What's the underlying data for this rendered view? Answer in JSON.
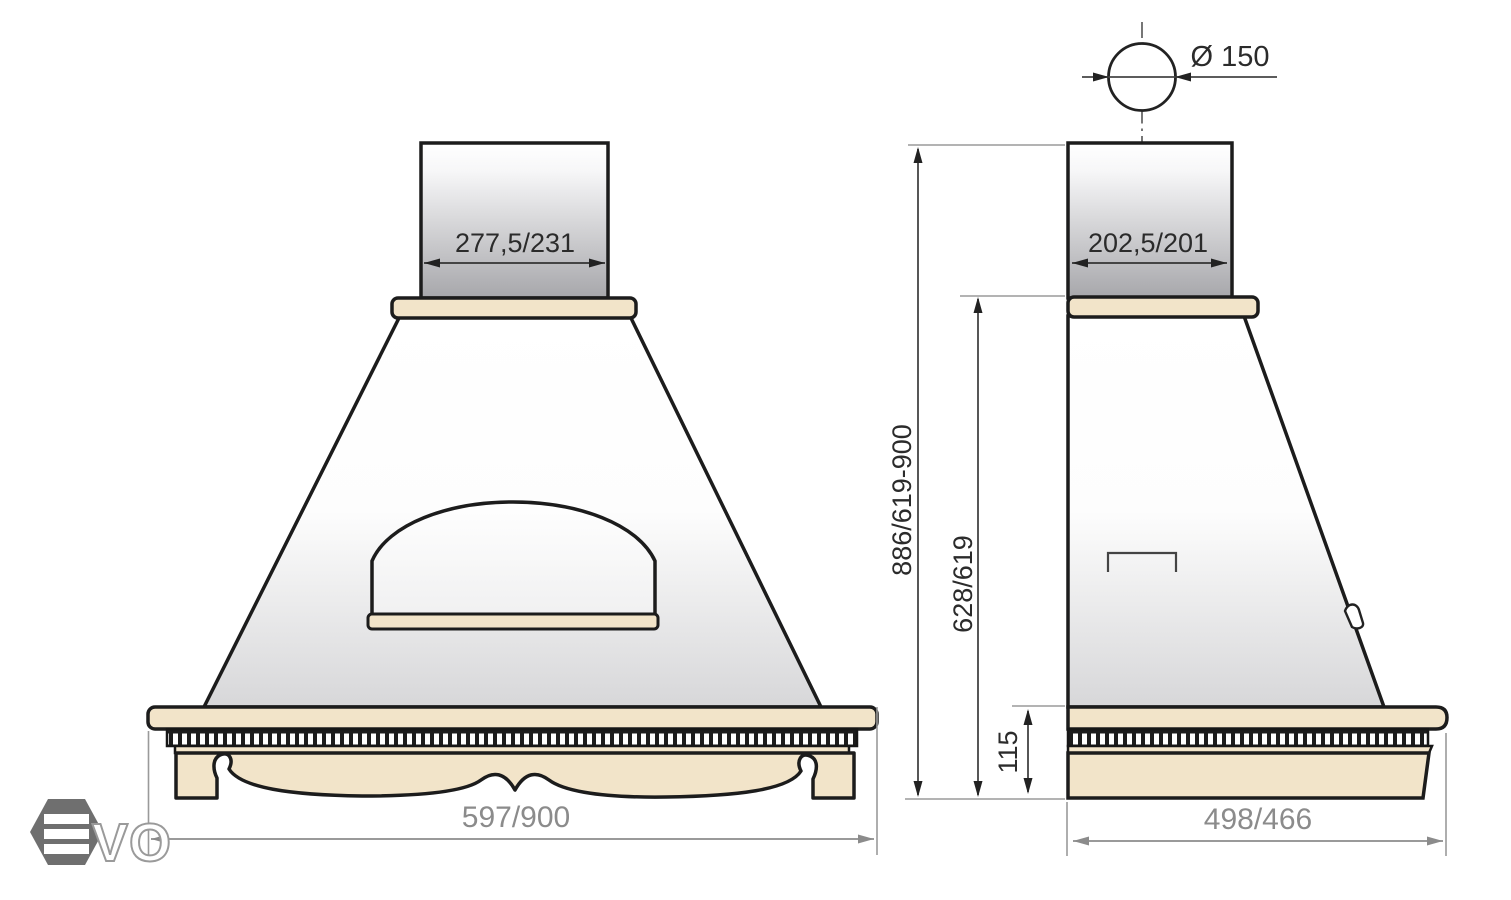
{
  "front_view": {
    "duct_width": "277,5/231",
    "overall_width": "597/900"
  },
  "side_view": {
    "flue_diameter": "Ø 150",
    "duct_depth": "202,5/201",
    "overall_height": "886/619-900",
    "canopy_height": "628/619",
    "base_height": "115",
    "overall_depth": "498/466"
  },
  "logo": {
    "outline_letters": "VO"
  },
  "colors": {
    "wood": "#f2e4c9",
    "duct_gray": "#a7a7ab",
    "canopy_gray": "#d7d7d9",
    "line": "#1c1c1c",
    "dim_text_gray": "#8b8b8b",
    "dim_text_dark": "#2b2b2b",
    "logo_gray": "#6f6f6f"
  }
}
